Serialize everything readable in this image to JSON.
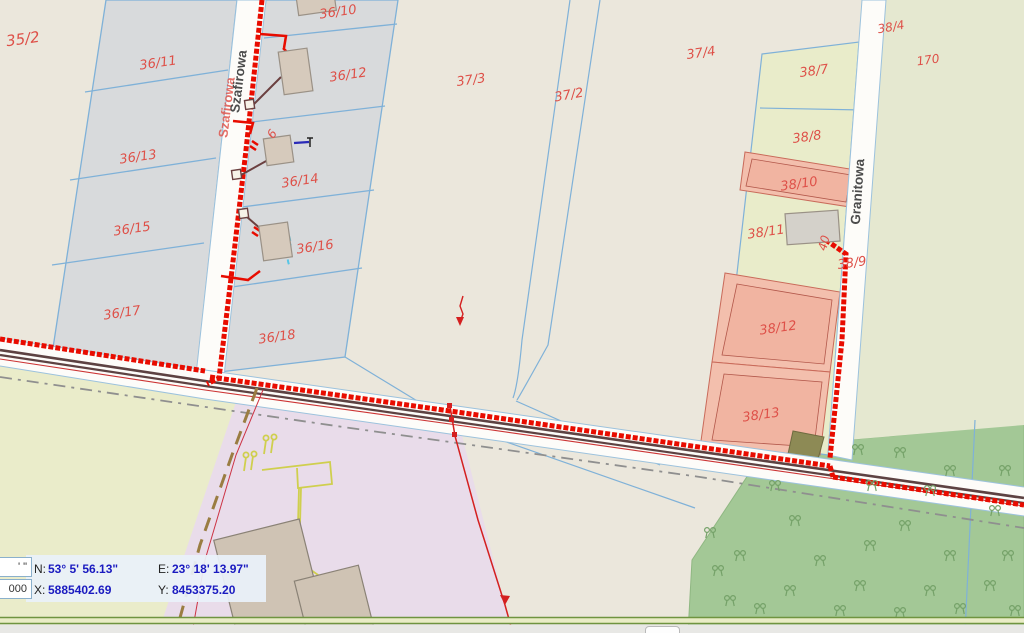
{
  "map": {
    "region_name": "cadastral-map-view",
    "street_labels": [
      {
        "name": "Szafirowa"
      },
      {
        "name": "Szafirowa"
      },
      {
        "name": "Granitowa"
      }
    ],
    "parcel_labels": [
      {
        "text": "35/2"
      },
      {
        "text": "36/11"
      },
      {
        "text": "36/13"
      },
      {
        "text": "36/15"
      },
      {
        "text": "36/17"
      },
      {
        "text": "36/10"
      },
      {
        "text": "36/12"
      },
      {
        "text": "36/14"
      },
      {
        "text": "36/16"
      },
      {
        "text": "36/18"
      },
      {
        "text": "37/3"
      },
      {
        "text": "37/2"
      },
      {
        "text": "37/4"
      },
      {
        "text": "38/4"
      },
      {
        "text": "170"
      },
      {
        "text": "38/7"
      },
      {
        "text": "38/8"
      },
      {
        "text": "38/10"
      },
      {
        "text": "38/11"
      },
      {
        "text": "38/9"
      },
      {
        "text": "38/12"
      },
      {
        "text": "38/13"
      }
    ],
    "address_labels": [
      {
        "text": "6"
      },
      {
        "text": "40"
      }
    ],
    "colors": {
      "background_beige": "#ebe7dc",
      "parcel_gray": "#d8dadc",
      "parcel_green_light": "#e9ecca",
      "parcel_khaki": "#e5e8d0",
      "forest_green": "#a3c896",
      "parcel_salmon": "#f3bfad",
      "parcel_purple": "#e9dcea",
      "boundary_blue": "#7fb1d8",
      "utility_red": "#e80c00",
      "road_maroon": "#5d4242",
      "label_red": "#de5048"
    }
  },
  "status_panel": {
    "format_box": "' \"",
    "scale_box": "000",
    "n_label": "N:",
    "n_value": "53° 5' 56.13\"",
    "e_label": "E:",
    "e_value": "23° 18' 13.97\"",
    "x_label": "X:",
    "x_value": "5885402.69",
    "y_label": "Y:",
    "y_value": "8453375.20"
  }
}
